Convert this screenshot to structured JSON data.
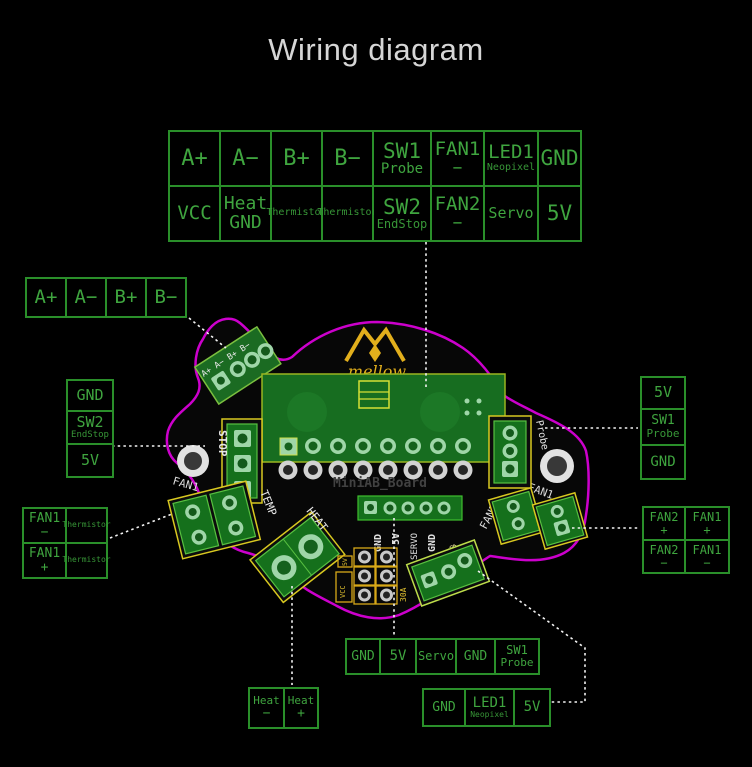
{
  "title": "Wiring diagram",
  "top_table": {
    "row1": [
      {
        "main": "A+"
      },
      {
        "main": "A−"
      },
      {
        "main": "B+"
      },
      {
        "main": "B−"
      },
      {
        "main": "SW1",
        "sub": "Probe"
      },
      {
        "main": "FAN1",
        "sub": "−"
      },
      {
        "main": "LED1",
        "sub": "Neopixel"
      },
      {
        "main": "GND"
      }
    ],
    "row2": [
      {
        "main": "VCC"
      },
      {
        "main": "Heat",
        "sub": "GND"
      },
      {
        "main": "Thermistor"
      },
      {
        "main": "Thermistor"
      },
      {
        "main": "SW2",
        "sub": "EndStop"
      },
      {
        "main": "FAN2",
        "sub": "−"
      },
      {
        "main": "Servo"
      },
      {
        "main": "5V"
      }
    ]
  },
  "left_ab": {
    "cells": [
      {
        "main": "A+"
      },
      {
        "main": "A−"
      },
      {
        "main": "B+"
      },
      {
        "main": "B−"
      }
    ]
  },
  "left_stack": {
    "cells": [
      {
        "main": "GND"
      },
      {
        "main": "SW2",
        "sub": "EndStop"
      },
      {
        "main": "5V"
      }
    ]
  },
  "left_fan": {
    "cells": [
      {
        "main": "FAN1",
        "sub": "−"
      },
      {
        "main": "Thermistor"
      },
      {
        "main": "FAN1",
        "sub": "+"
      },
      {
        "main": "Thermistor"
      }
    ]
  },
  "right_stack": {
    "cells": [
      {
        "main": "5V"
      },
      {
        "main": "SW1",
        "sub": "Probe"
      },
      {
        "main": "GND"
      }
    ]
  },
  "right_fan": {
    "cells": [
      {
        "main": "FAN2",
        "sub": "+"
      },
      {
        "main": "FAN1",
        "sub": "+"
      },
      {
        "main": "FAN2",
        "sub": "−"
      },
      {
        "main": "FAN1",
        "sub": "−"
      }
    ]
  },
  "bottom_servo_row": {
    "cells": [
      {
        "main": "GND"
      },
      {
        "main": "5V"
      },
      {
        "main": "Servo"
      },
      {
        "main": "GND"
      },
      {
        "main": "SW1",
        "sub": "Probe"
      }
    ]
  },
  "bottom_led_row": {
    "cells": [
      {
        "main": "GND"
      },
      {
        "main": "LED1",
        "sub": "Neopixel"
      },
      {
        "main": "5V"
      }
    ]
  },
  "heat_row": {
    "cells": [
      {
        "main": "Heat",
        "sub": "−"
      },
      {
        "main": "Heat",
        "sub": "+"
      }
    ]
  },
  "board": {
    "name": "MiniAB_Board",
    "logo_text": "mellow",
    "silk": {
      "ab_pins": "A+ A− B+ B−",
      "stop": "STOP",
      "temp": "TEMP",
      "heat": "HEAT",
      "probe": "Probe",
      "fan1_left": "FAN1",
      "fan1_right": "FAN1",
      "fan2": "FAN2",
      "pin_gnd_1": "GND",
      "pin_5v": "5V",
      "pin_servo": "SERVO",
      "pin_gnd_2": "GND",
      "pin_rgb_led": "RGB_LED",
      "pin_sw1": "SW1",
      "fuse": "30A",
      "vcc": "VCC",
      "v5": "5V"
    }
  },
  "colors": {
    "background": "#000000",
    "label_text_green": "#3fa53f",
    "grid_green": "#2a8f2a",
    "board_outline": "#cc00cc",
    "logo_gold": "#e2af1c",
    "pcb_green": "#15701c",
    "pad_green": "#9fd6a8",
    "dashed_white": "#f2f2f2"
  }
}
